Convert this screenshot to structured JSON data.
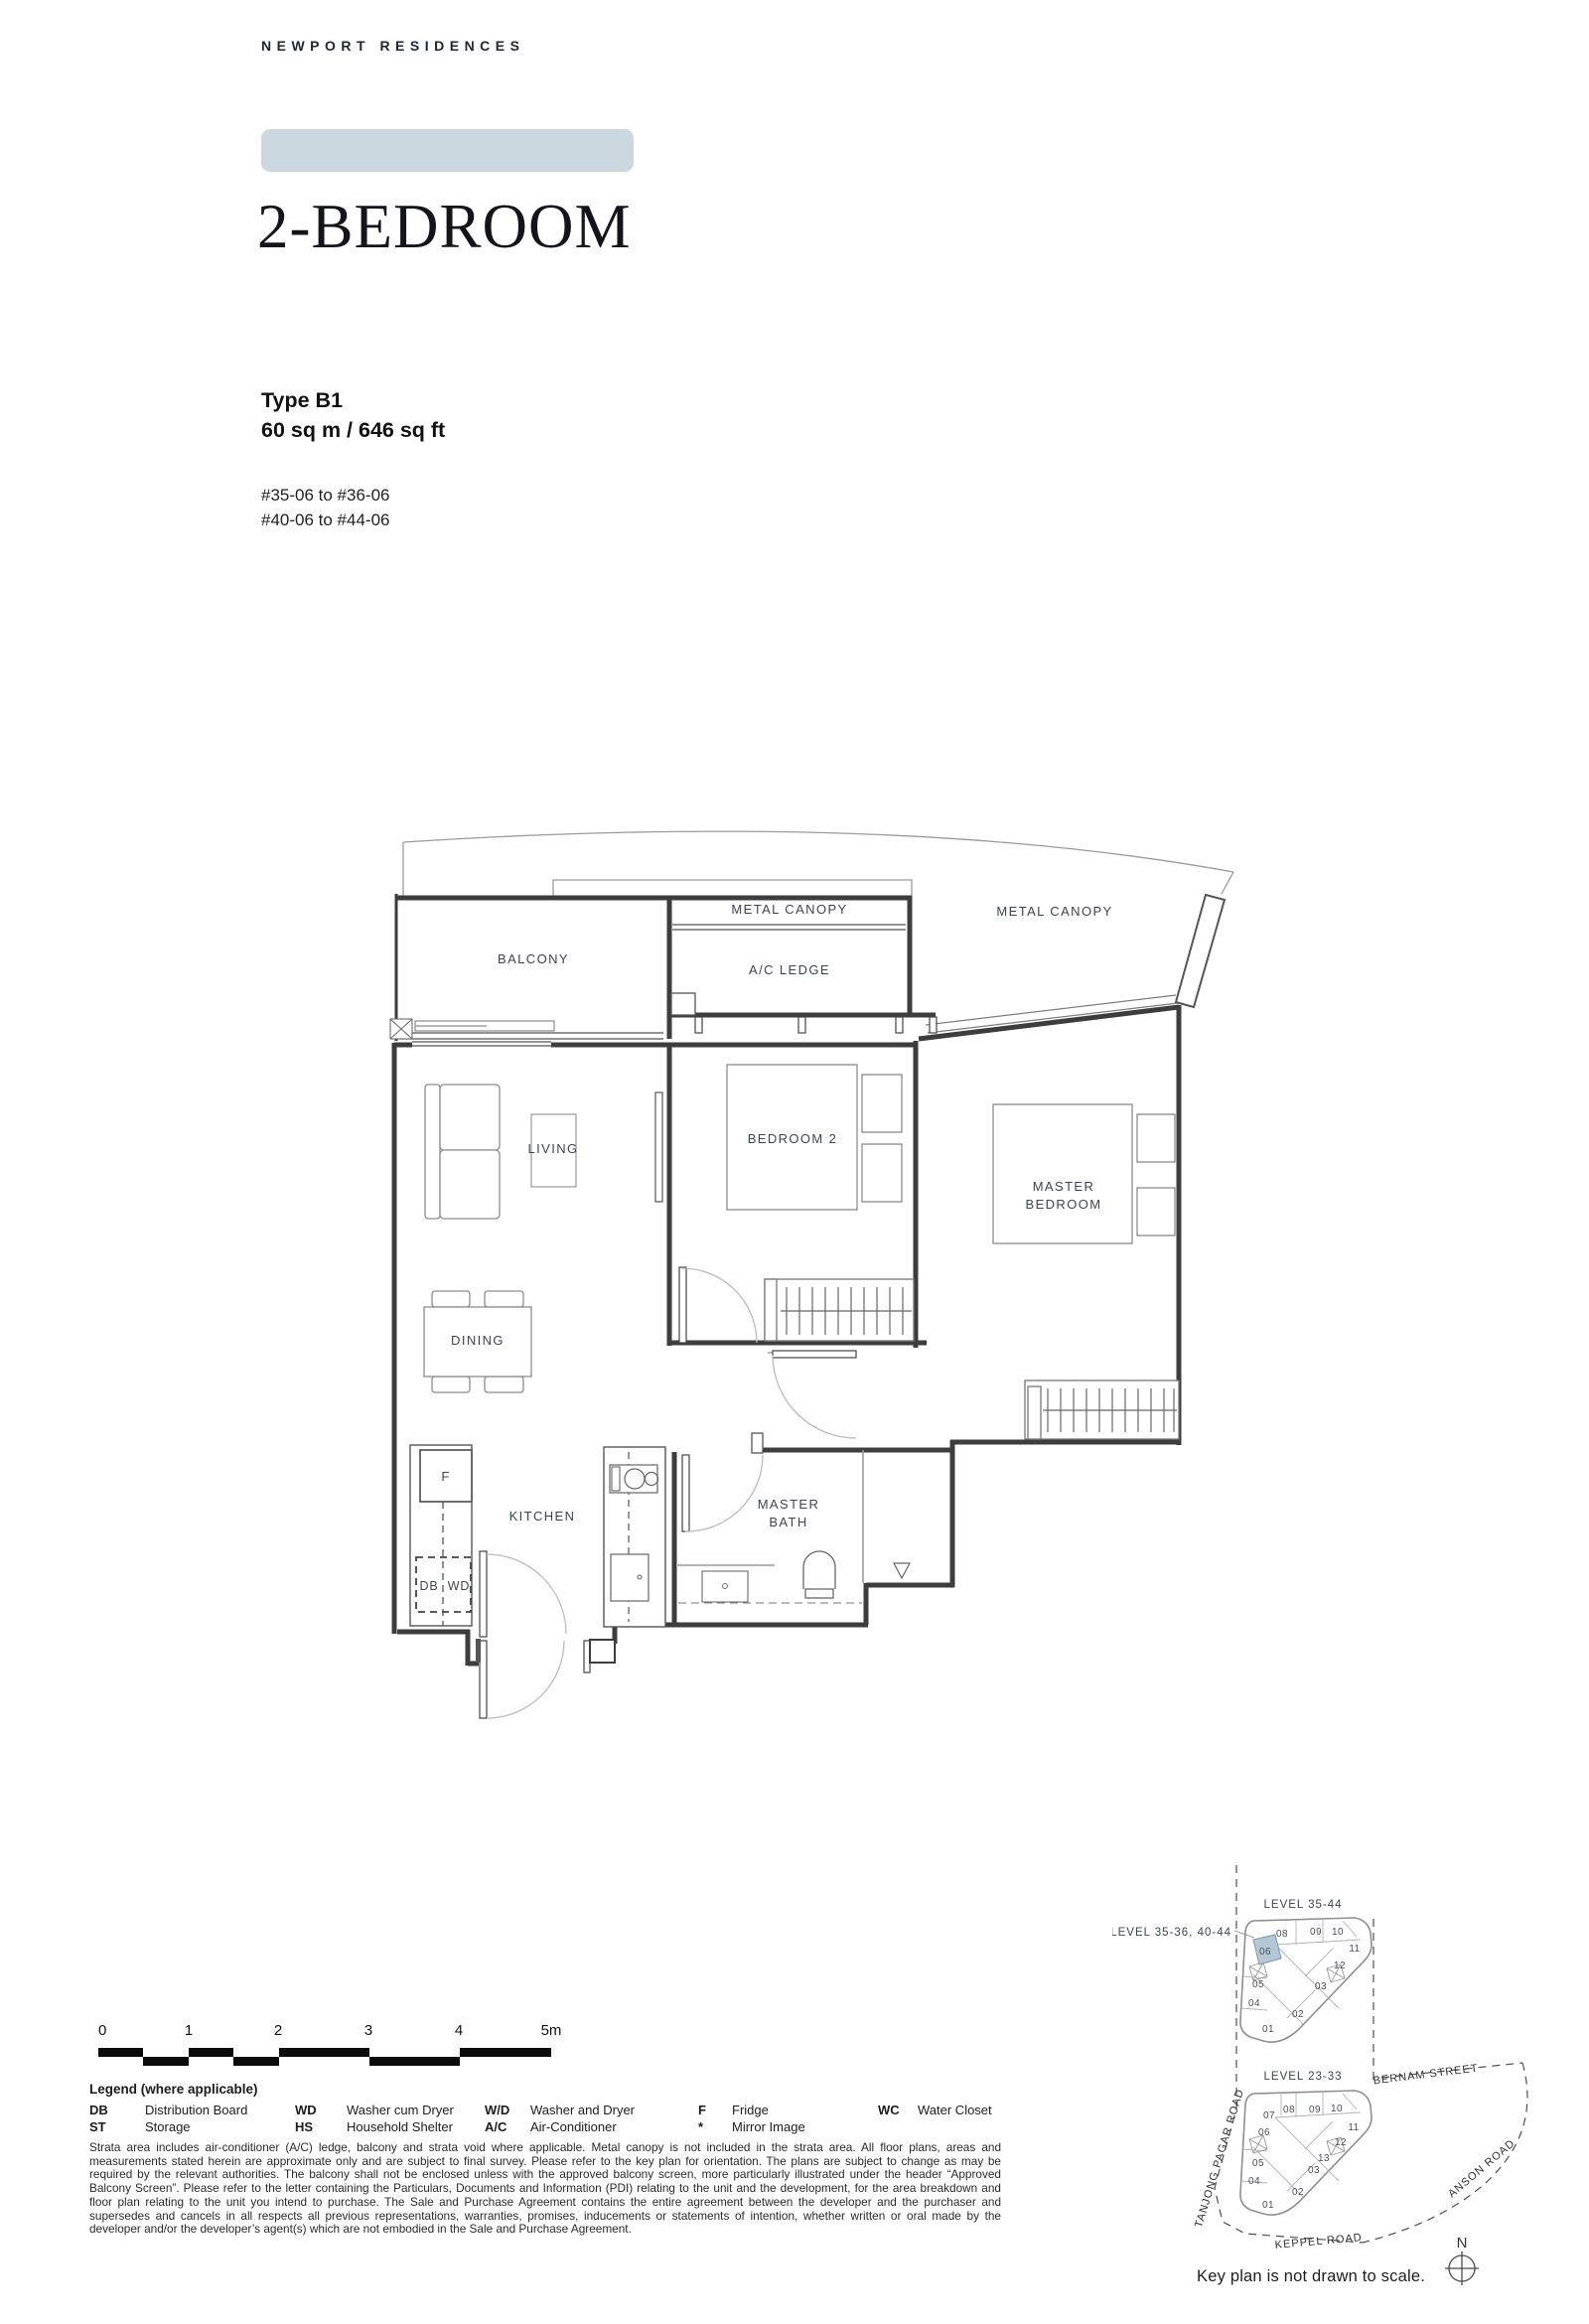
{
  "page": {
    "brand": "NEWPORT RESIDENCES",
    "title": "2-BEDROOM",
    "type_label": "Type B1",
    "area": "60 sq m / 646 sq ft",
    "unit_range_1": "#35-06 to #36-06",
    "unit_range_2": "#40-06 to #44-06"
  },
  "colors": {
    "banner": "#ccd8df",
    "keyplan_highlight": "#b5c7d4",
    "label_ink": "#3a4656"
  },
  "floorplan": {
    "labels": {
      "balcony": "BALCONY",
      "metal_canopy_mid": "METAL CANOPY",
      "ac_ledge": "A/C LEDGE",
      "metal_canopy_right": "METAL CANOPY",
      "living": "LIVING",
      "bedroom2": "BEDROOM 2",
      "master_line1": "MASTER",
      "master_line2": "BEDROOM",
      "dining": "DINING",
      "kitchen": "KITCHEN",
      "bath_line1": "MASTER",
      "bath_line2": "BATH",
      "fridge": "F",
      "db": "DB",
      "wd": "WD"
    }
  },
  "scalebar": {
    "ticks": [
      "0",
      "1",
      "2",
      "3",
      "4",
      "5m"
    ]
  },
  "legend": {
    "heading": "Legend (where applicable)",
    "items": [
      {
        "abbr": "DB",
        "term": "Distribution Board"
      },
      {
        "abbr": "ST",
        "term": "Storage"
      },
      {
        "abbr": "WD",
        "term": "Washer cum Dryer"
      },
      {
        "abbr": "HS",
        "term": "Household Shelter"
      },
      {
        "abbr": "W/D",
        "term": "Washer and Dryer"
      },
      {
        "abbr": "A/C",
        "term": "Air-Conditioner"
      },
      {
        "abbr": "F",
        "term": "Fridge"
      },
      {
        "abbr": "*",
        "term": "Mirror Image"
      },
      {
        "abbr": "WC",
        "term": "Water Closet"
      }
    ]
  },
  "disclaimer": "Strata area includes air-conditioner (A/C) ledge, balcony and strata void where applicable. Metal canopy is not included in the strata area. All floor plans, areas and measurements stated herein are approximate only and are subject to final survey. Please refer to the key plan for orientation. The plans are subject to change as may be required by the relevant authorities. The balcony shall not be enclosed unless with the approved balcony screen, more particularly illustrated under the header “Approved Balcony Screen”. Please refer to the letter containing the Particulars, Documents and Information (PDI) relating to the unit and the development, for the area breakdown and floor plan relating to the unit you intend to purchase. The Sale and Purchase Agreement contains the entire agreement between the developer and the purchaser and supersedes and cancels in all respects all previous representations, warranties, promises, inducements or statements of intention, whether written or oral made by the developer and/or the developer’s agent(s) which are not embodied in the Sale and Purchase Agreement.",
  "keyplan": {
    "level_top": "LEVEL  35-44",
    "callout": "LEVEL 35-36, 40-44",
    "level_bottom": "LEVEL  23-33",
    "highlighted_unit": "06",
    "roads": {
      "bernam": "BERNAM STREET",
      "tanjong": "TANJONG PAGAR ROAD",
      "anson": "ANSON ROAD",
      "keppel": "KEPPEL ROAD"
    },
    "note": "Key plan is not drawn to scale.",
    "north": "N",
    "top_units": [
      "08",
      "09",
      "10",
      "11",
      "12",
      "06",
      "05",
      "03",
      "04",
      "02",
      "01"
    ],
    "bottom_units": [
      "07",
      "08",
      "09",
      "10",
      "11",
      "12",
      "13",
      "06",
      "05",
      "03",
      "04",
      "02",
      "01"
    ]
  }
}
